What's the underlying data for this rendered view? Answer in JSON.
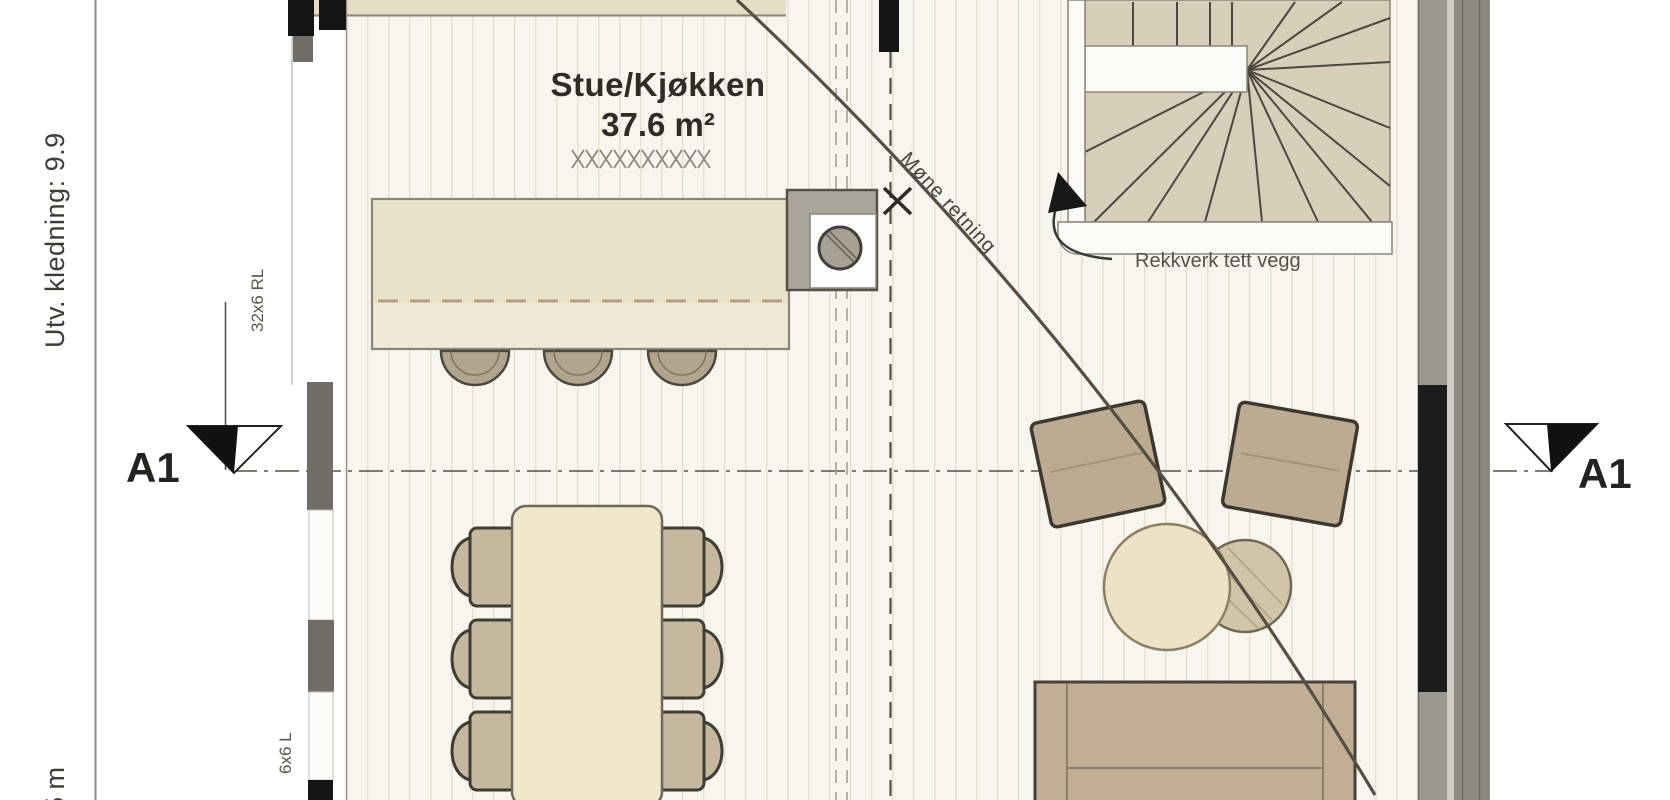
{
  "plan": {
    "room": {
      "name": "Stue/Kjøkken",
      "area": "37.6 m²"
    },
    "annotations": {
      "railing": "Rekkverk tett vegg",
      "ridge": "Møne retning",
      "cladding": "Utv. kledning: 9.9",
      "bottom_dim": "5 m",
      "framing_upper": "32x6 RL",
      "framing_lower": "6x6 L"
    },
    "section_markers": {
      "left": "A1",
      "right": "A1"
    },
    "furniture": [
      "kitchen counter",
      "sink",
      "bar stools",
      "dining table",
      "dining chairs",
      "armchairs",
      "coffee tables",
      "sofa",
      "winder staircase"
    ],
    "colors": {
      "floor": "#f8f5ee",
      "floor_stripe": "#e8e1d2",
      "stair_tread": "#d8cfba",
      "counter": "#eae1cb",
      "furniture_tan": "#bcab92",
      "wall_gray": "#9b9791",
      "line_dark": "#4c483e"
    }
  }
}
